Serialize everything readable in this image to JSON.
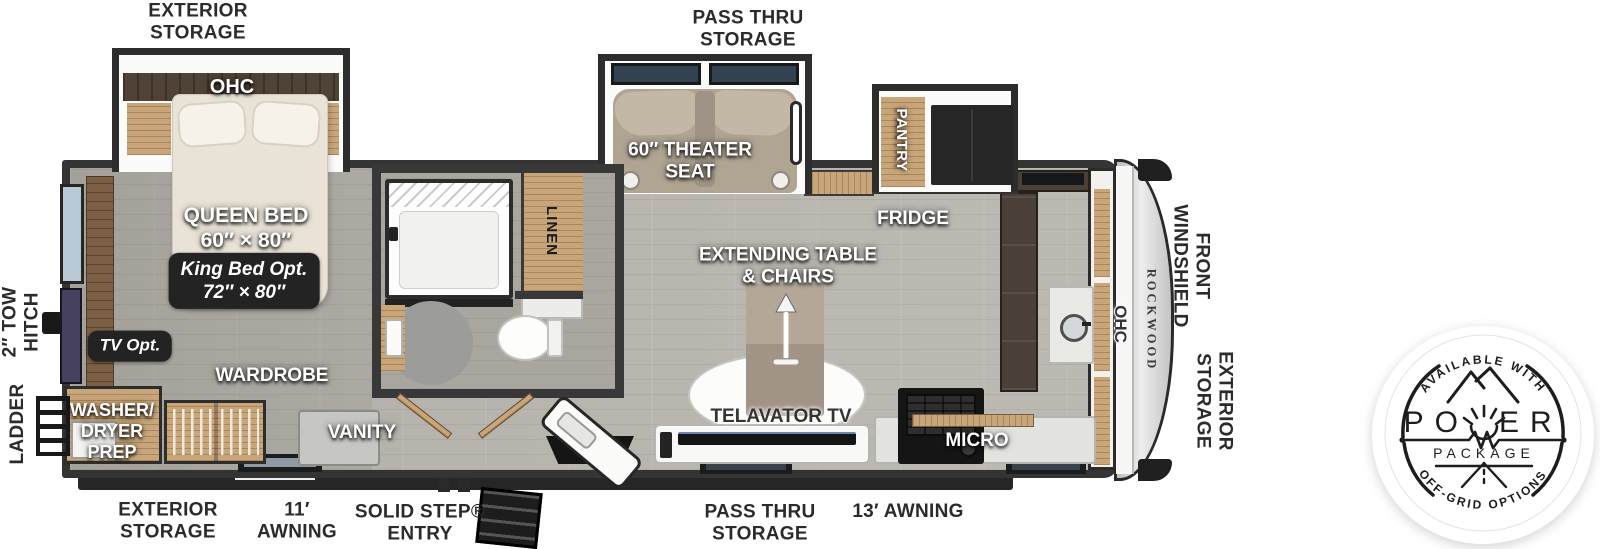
{
  "plan": {
    "exterior": {
      "storage_top": "EXTERIOR\nSTORAGE",
      "pass_thru_top": "PASS THRU\nSTORAGE",
      "tow_hitch": "2″ TOW\nHITCH",
      "ladder": "LADDER",
      "front_windshield": "FRONT\nWINDSHIELD",
      "front_exterior_storage": "EXTERIOR\nSTORAGE",
      "storage_bottom": "EXTERIOR\nSTORAGE",
      "awning_small": "11′\nAWNING",
      "entry": "SOLID STEP®\nENTRY",
      "pass_thru_bottom": "PASS THRU\nSTORAGE",
      "awning_large": "13′ AWNING"
    },
    "interior": {
      "ohc_bedroom": "OHC",
      "queen_bed": "QUEEN BED\n60″ × 80″",
      "king_bed_opt": "King Bed Opt.\n72″ × 80″",
      "tv_opt": "TV Opt.",
      "wardrobe": "WARDROBE",
      "washer_dryer_prep": "WASHER/\nDRYER\nPREP",
      "vanity": "VANITY",
      "linen": "LINEN",
      "theater_seat": "60″ THEATER\nSEAT",
      "pantry": "PANTRY",
      "fridge": "FRIDGE",
      "extending_table": "EXTENDING TABLE\n& CHAIRS",
      "telavator_tv": "TELAVATOR TV",
      "micro": "MICRO",
      "ohc_front": "OHC",
      "brand": "ROCKWOOD"
    },
    "badge": {
      "top": "AVAILABLE WITH",
      "power_left": "PO",
      "power_right": "ER",
      "package": "PACKAGE",
      "bottom": "OFF-GRID OPTIONS"
    },
    "colors": {
      "wall": "#343434",
      "floor": "#b5b3ab",
      "wood": "#c8a67a",
      "dark_wood": "#504235",
      "bed_fabric": "#e9e3d7",
      "theater_seat": "#b0a492",
      "appliance_dark": "#1a1a1a",
      "window_glass": "#b9c9d6",
      "chip_bg": "#232323"
    }
  }
}
